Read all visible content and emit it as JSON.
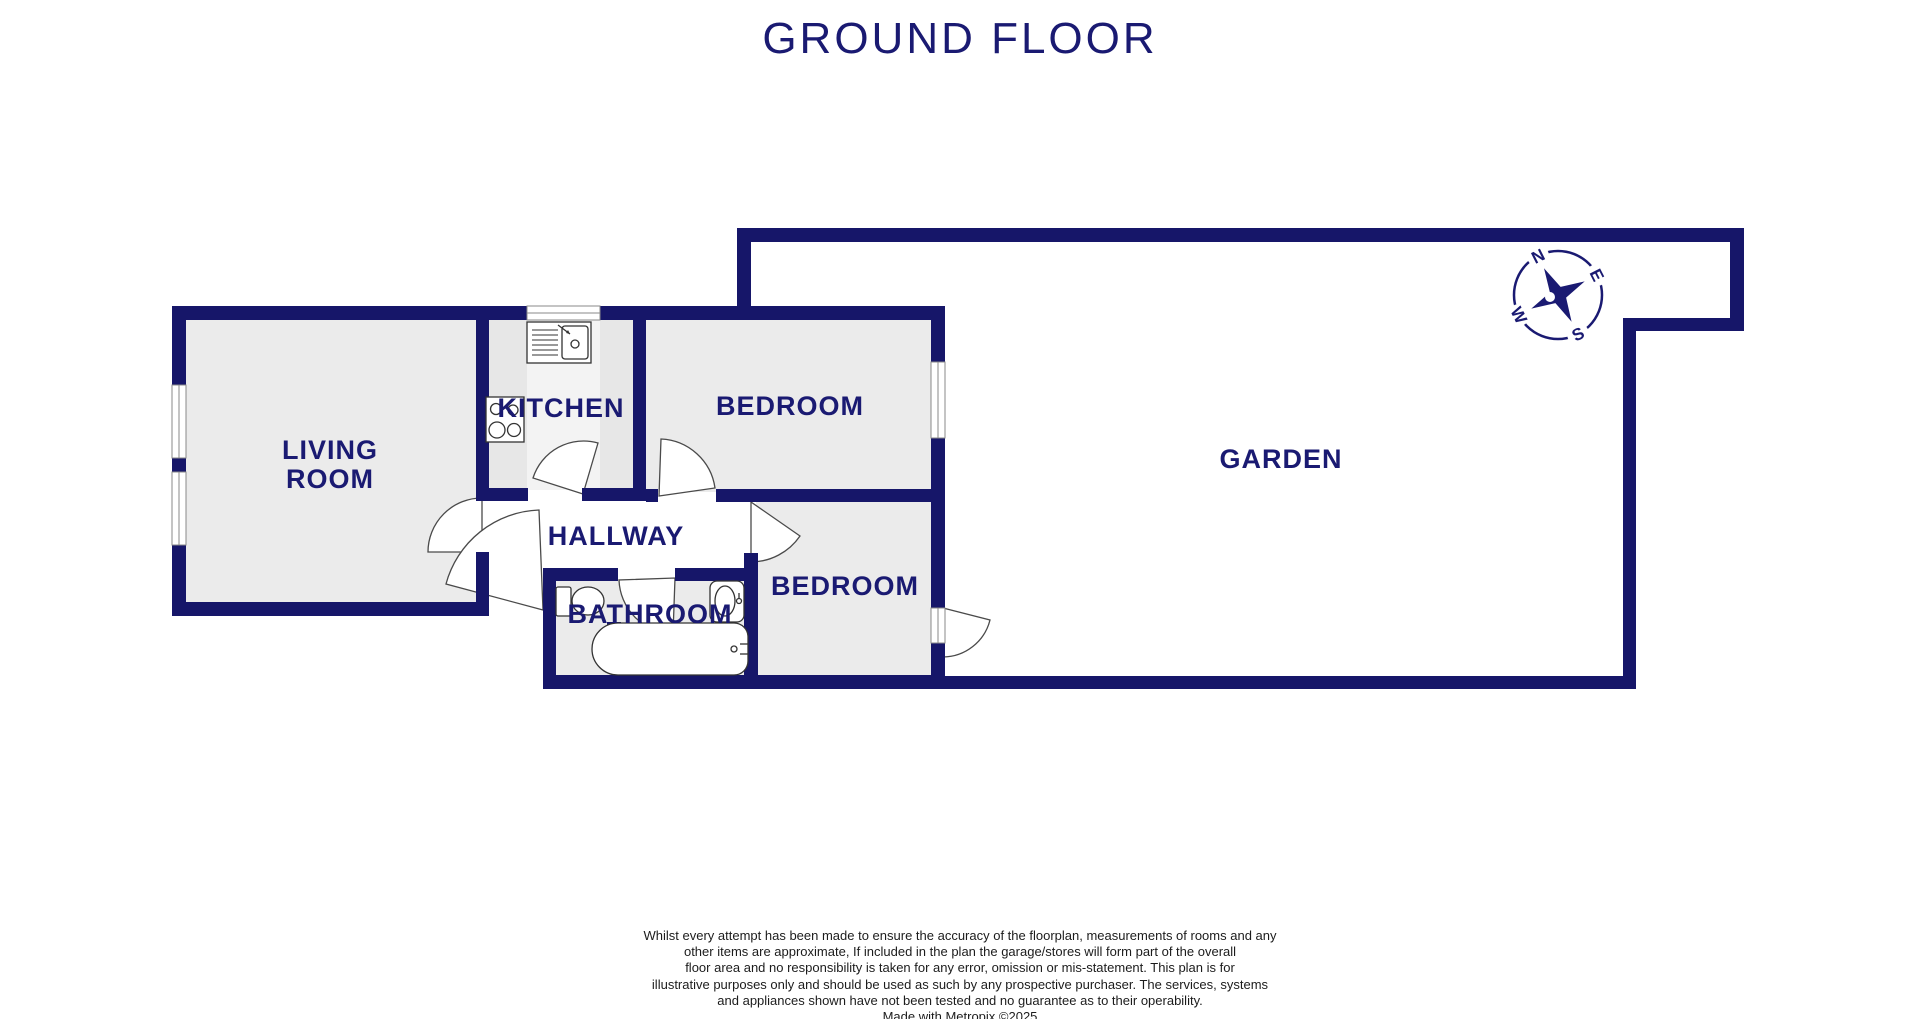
{
  "title": "GROUND FLOOR",
  "colors": {
    "wall": "#161669",
    "label_text": "#1a1a72",
    "room_fill": "#ebebeb",
    "kitchen_band": "#f3f3f3",
    "door_arc_stroke": "#4a4a4a",
    "fixture_stroke": "#333333",
    "background": "#ffffff",
    "disclaimer_text": "#1c1c1c"
  },
  "rooms": {
    "living_room_line1": "LIVING",
    "living_room_line2": "ROOM",
    "kitchen": "KITCHEN",
    "bedroom_top": "BEDROOM",
    "hallway": "HALLWAY",
    "bathroom": "BATHROOM",
    "bedroom_bottom": "BEDROOM",
    "garden": "GARDEN"
  },
  "compass": {
    "north": "N",
    "east": "E",
    "south": "S",
    "west": "W"
  },
  "disclaimer": {
    "line1": "Whilst every attempt has been made to ensure the accuracy of the floorplan, measurements of rooms and any",
    "line2": "other items are approximate, If included in the plan the garage/stores will form part of the overall",
    "line3": "floor area and no responsibility is taken for any error, omission or mis-statement. This plan is for",
    "line4": "illustrative purposes only and should be used as such by any prospective purchaser. The services, systems",
    "line5": "and appliances shown have not been tested and no guarantee as to their operability.",
    "line6": "Made with Metropix ©2025"
  }
}
